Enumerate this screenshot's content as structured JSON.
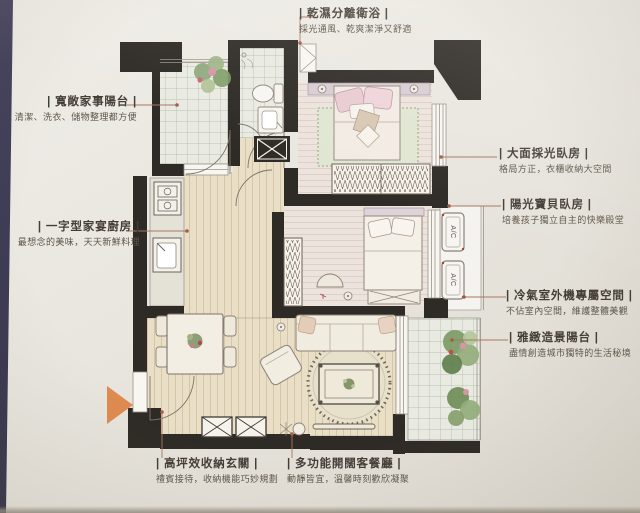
{
  "callouts": [
    {
      "id": "wet-dry-bathroom",
      "title": "| 乾濕分離衛浴 |",
      "sub": "採光通風、乾爽潔淨又舒適"
    },
    {
      "id": "utility-balcony",
      "title": "| 寬敞家事陽台 |",
      "sub": "清潔、洗衣、儲物整理都方便"
    },
    {
      "id": "kitchen",
      "title": "| 一字型家宴廚房 |",
      "sub": "最想念的美味，天天新鮮料理"
    },
    {
      "id": "master-bedroom",
      "title": "| 大面採光臥房 |",
      "sub": "格局方正，衣櫃收納大空間"
    },
    {
      "id": "kids-bedroom",
      "title": "| 陽光寶貝臥房 |",
      "sub": "培養孩子獨立自主的快樂殿堂"
    },
    {
      "id": "ac-space",
      "title": "| 冷氣室外機專屬空間 |",
      "sub": "不佔室內空間，維護整體美觀"
    },
    {
      "id": "scenic-balcony",
      "title": "| 雅緻造景陽台 |",
      "sub": "盡情創造城市獨特的生活秘境"
    },
    {
      "id": "entry",
      "title": "| 高坪效收納玄關 |",
      "sub": "禮賓接待，收納機能巧妙規劃"
    },
    {
      "id": "living-dining",
      "title": "| 多功能開闊客餐廳 |",
      "sub": "動靜皆宜，溫馨時刻歡欣凝聚"
    }
  ],
  "plan": {
    "ac_label": "A/C",
    "wall_color": "#2e2a25",
    "entry_arrow_color": "#de8a50",
    "leader_color": "#a8785f"
  }
}
